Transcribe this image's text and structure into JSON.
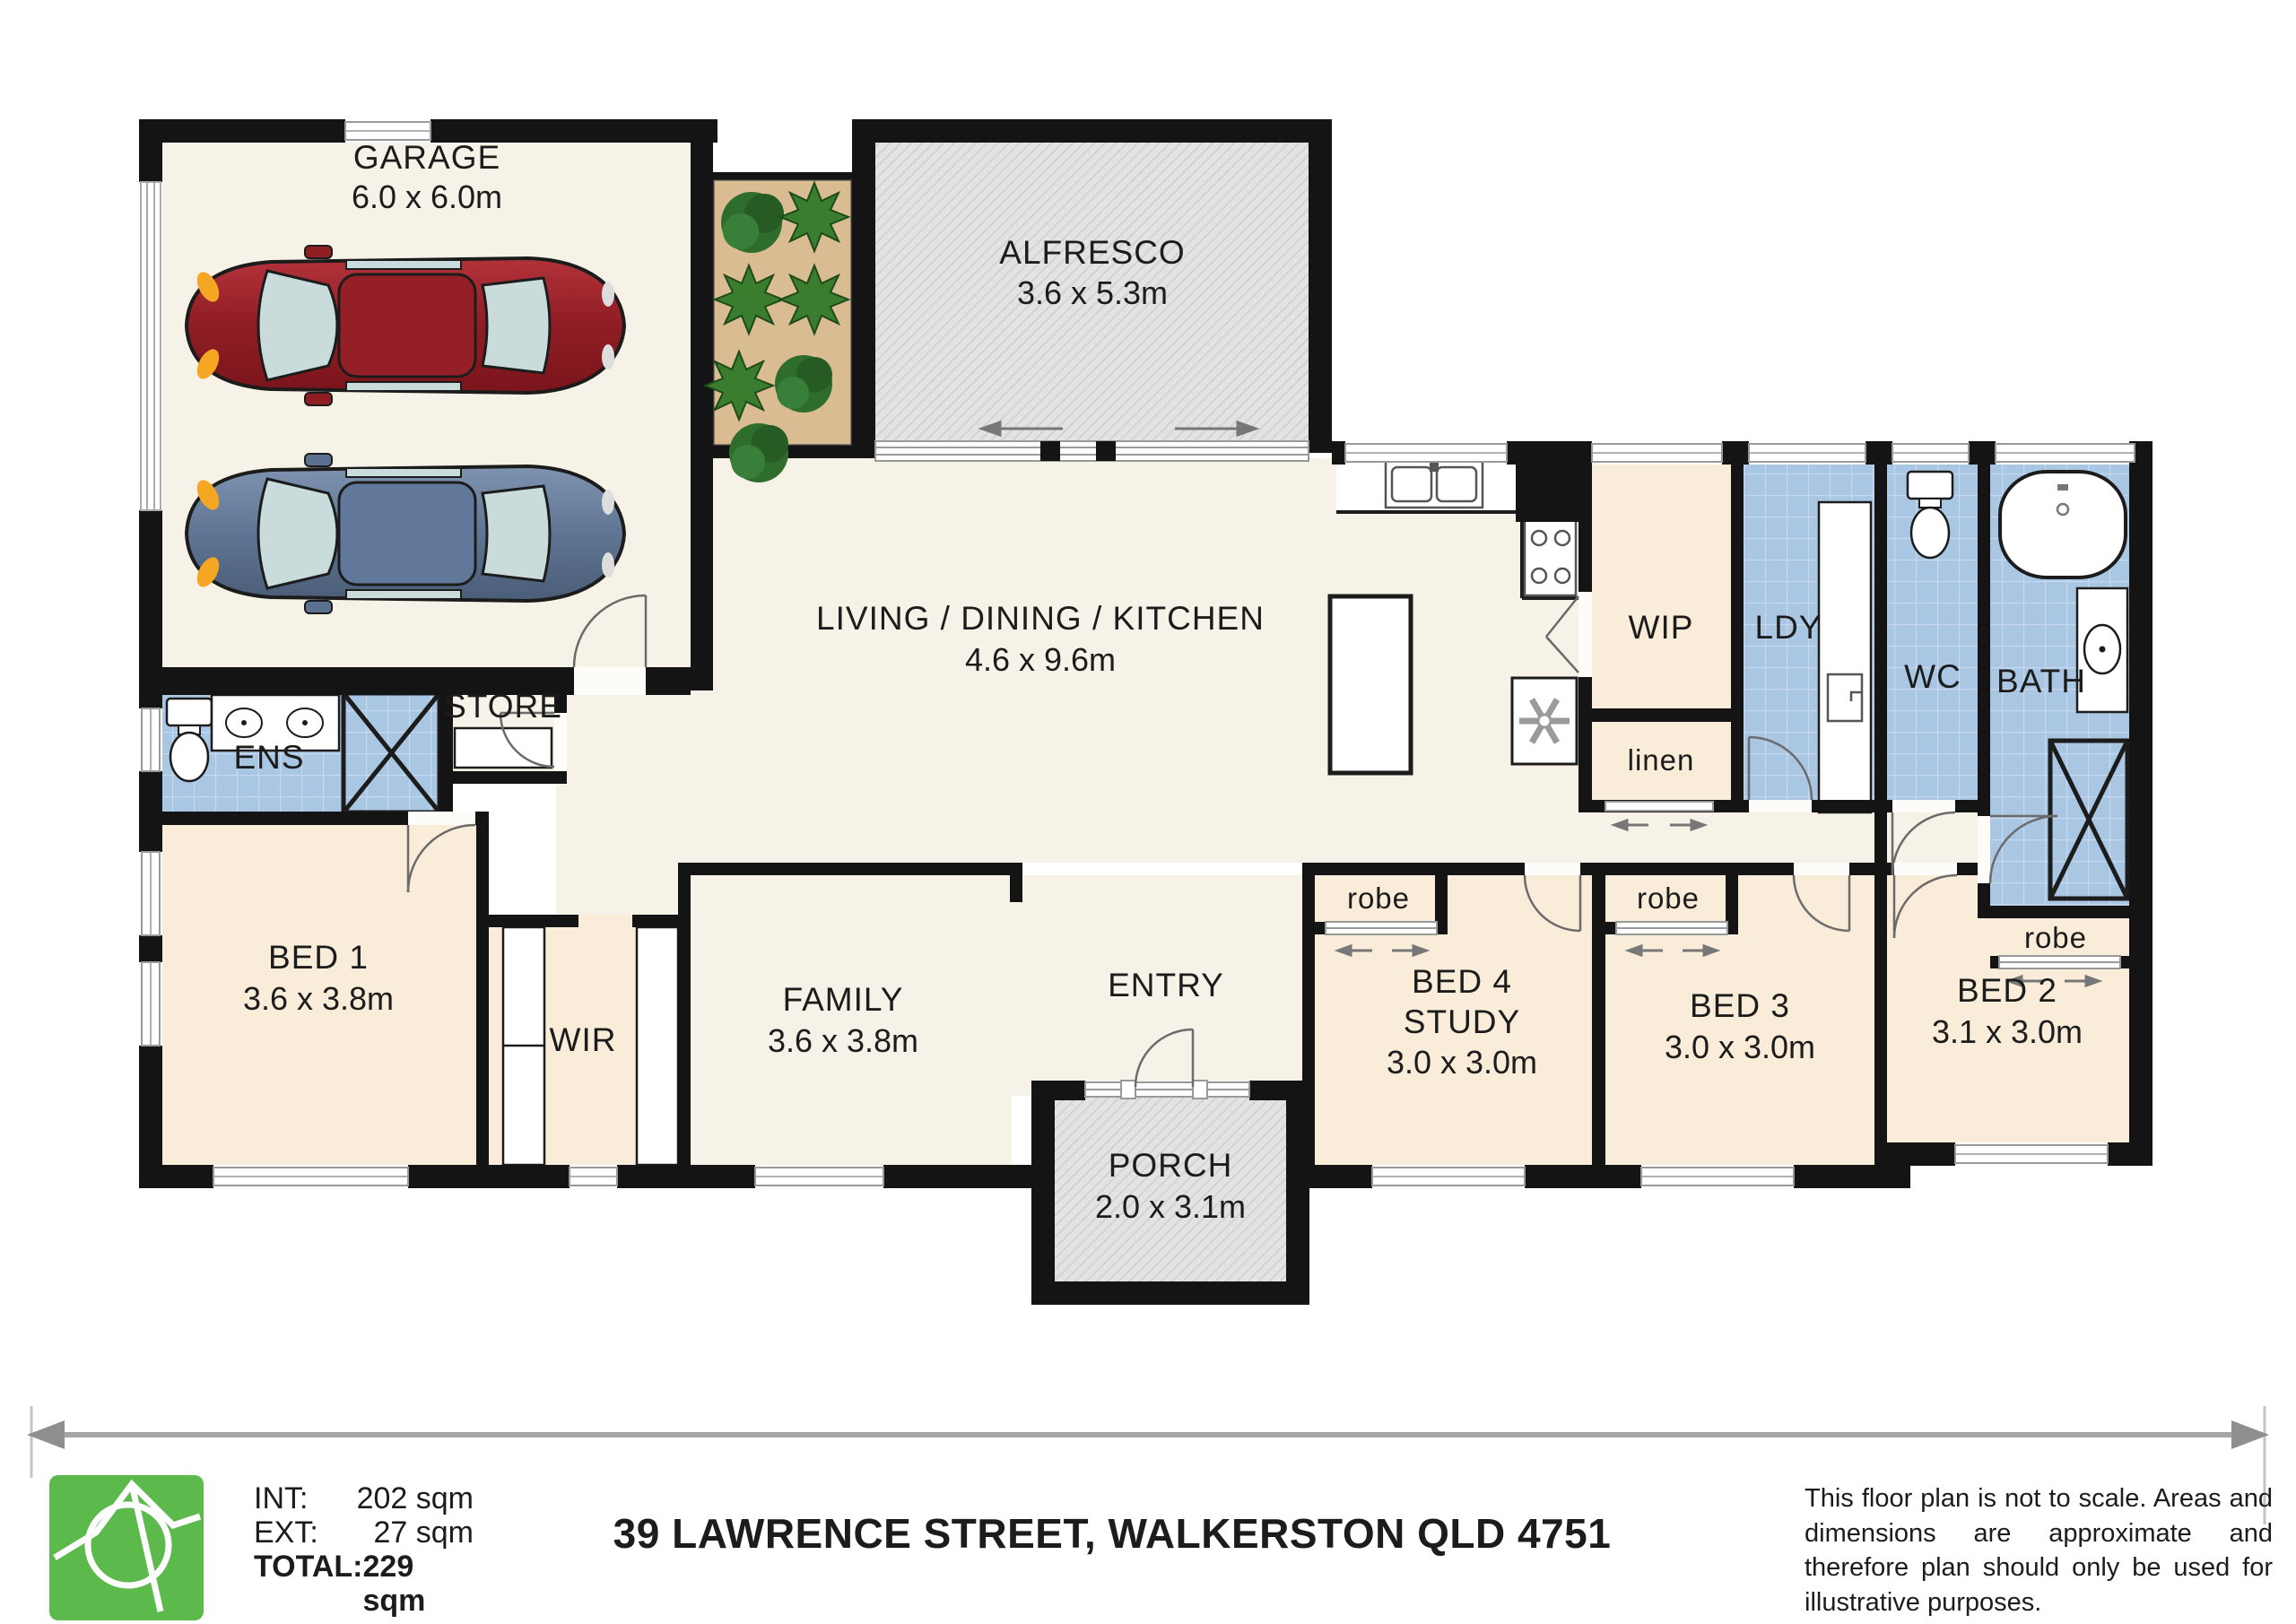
{
  "plan": {
    "rooms": {
      "garage": {
        "name": "GARAGE",
        "dims": "6.0 x 6.0m"
      },
      "alfresco": {
        "name": "ALFRESCO",
        "dims": "3.6 x 5.3m"
      },
      "living": {
        "name": "LIVING / DINING / KITCHEN",
        "dims": "4.6 x 9.6m"
      },
      "wip": {
        "name": "WIP"
      },
      "linen": {
        "name": "linen"
      },
      "ldy": {
        "name": "LDY"
      },
      "wc": {
        "name": "WC"
      },
      "bath": {
        "name": "BATH"
      },
      "ens": {
        "name": "ENS"
      },
      "store": {
        "name": "STORE"
      },
      "bed1": {
        "name": "BED 1",
        "dims": "3.6 x 3.8m"
      },
      "wir": {
        "name": "WIR"
      },
      "family": {
        "name": "FAMILY",
        "dims": "3.6 x 3.8m"
      },
      "entry": {
        "name": "ENTRY"
      },
      "porch": {
        "name": "PORCH",
        "dims": "2.0 x 3.1m"
      },
      "bed4": {
        "name": "BED 4",
        "name2": "STUDY",
        "dims": "3.0 x 3.0m"
      },
      "bed3": {
        "name": "BED 3",
        "dims": "3.0 x 3.0m"
      },
      "bed2": {
        "name": "BED 2",
        "dims": "3.1 x 3.0m"
      },
      "robe": {
        "name": "robe"
      }
    },
    "colors": {
      "wall": "#141414",
      "floor_cream": "#f7f2e7",
      "floor_bedroom": "#f9ecd9",
      "wet_tile": "#a9c6e2",
      "garden": "#d9bc91",
      "paving": "#e3e3e3",
      "car_red": "#a8242b",
      "car_blue": "#6c82a0",
      "logo_green": "#5cb94c"
    },
    "icons": [
      "red-car-icon",
      "blue-car-icon",
      "bush-plant-icon",
      "spiky-plant-icon",
      "toilet-icon",
      "double-vanity-icon",
      "shower-icon",
      "kitchen-sink-icon",
      "stove-icon",
      "fan-icon",
      "bathtub-icon",
      "laundry-tub-icon",
      "scale-arrow-icon",
      "compass-logo-icon"
    ]
  },
  "footer": {
    "areas": [
      {
        "label": "INT:",
        "value": "202 sqm"
      },
      {
        "label": "EXT:",
        "value": "27 sqm"
      },
      {
        "label": "TOTAL:",
        "value": "229 sqm"
      }
    ],
    "address": "39 LAWRENCE STREET, WALKERSTON QLD 4751",
    "disclaimer": "This floor plan is not to scale. Areas and dimensions are approximate and therefore plan should only be used for illustrative purposes."
  }
}
